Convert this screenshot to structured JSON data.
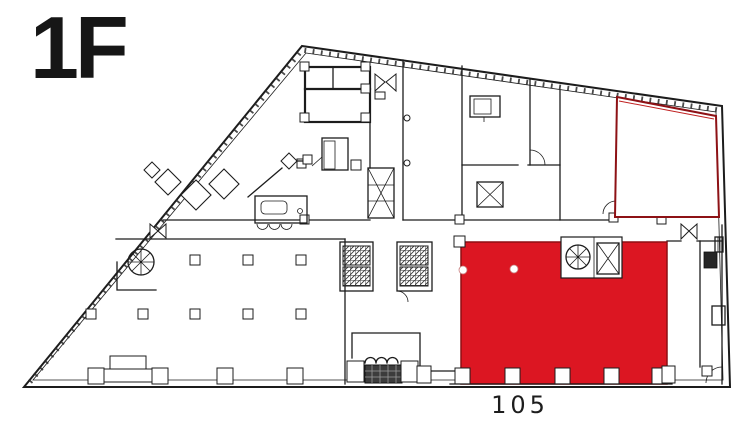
{
  "floor_plan": {
    "floor_label": "1F",
    "unit_label": "105",
    "colors": {
      "highlight_fill": "#dc1622",
      "highlight_border": "#8e0e13",
      "outline_room_border": "#8d1115",
      "wall_line": "#1c1c1c",
      "background": "#ffffff"
    }
  }
}
